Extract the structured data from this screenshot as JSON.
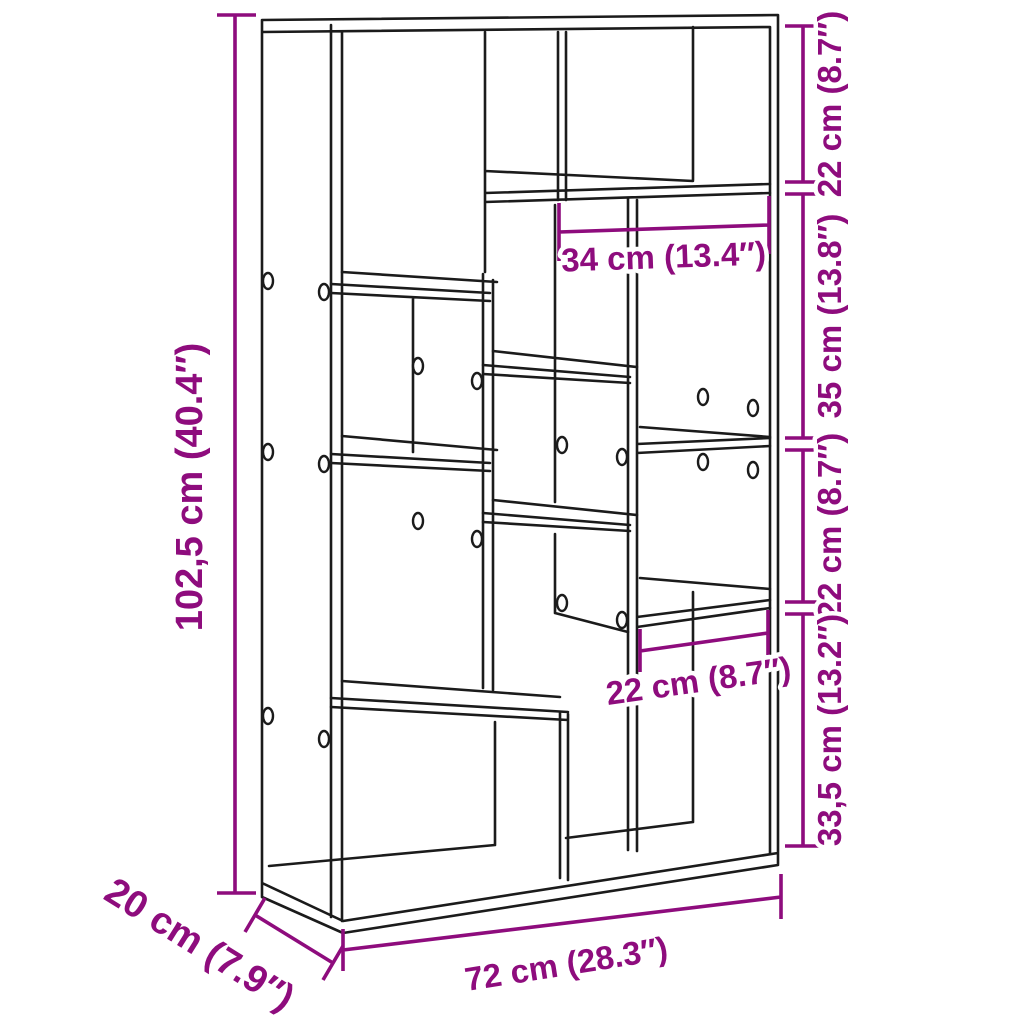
{
  "page": {
    "background": "#ffffff"
  },
  "diagram": {
    "kind": "product-dimension-line-drawing",
    "subject": "staggered-cube bookshelf room divider",
    "line_color": "#1b1b1b",
    "dimension_color": "#8E0C7D",
    "labels": {
      "overall_height": "102,5 cm (40.4″)",
      "overall_width": "72 cm (28.3″)",
      "overall_depth": "20 cm (7.9″)",
      "top_compartment_width": "34 cm (13.4″)",
      "lower_right_compartment_width": "22 cm (8.7″)",
      "right_segment_top": "22 cm (8.7″)",
      "right_segment_second": "35 cm (13.8″)",
      "right_segment_third": "22 cm (8.7″)",
      "right_segment_bottom": "33,5 cm (13.2″)"
    }
  }
}
